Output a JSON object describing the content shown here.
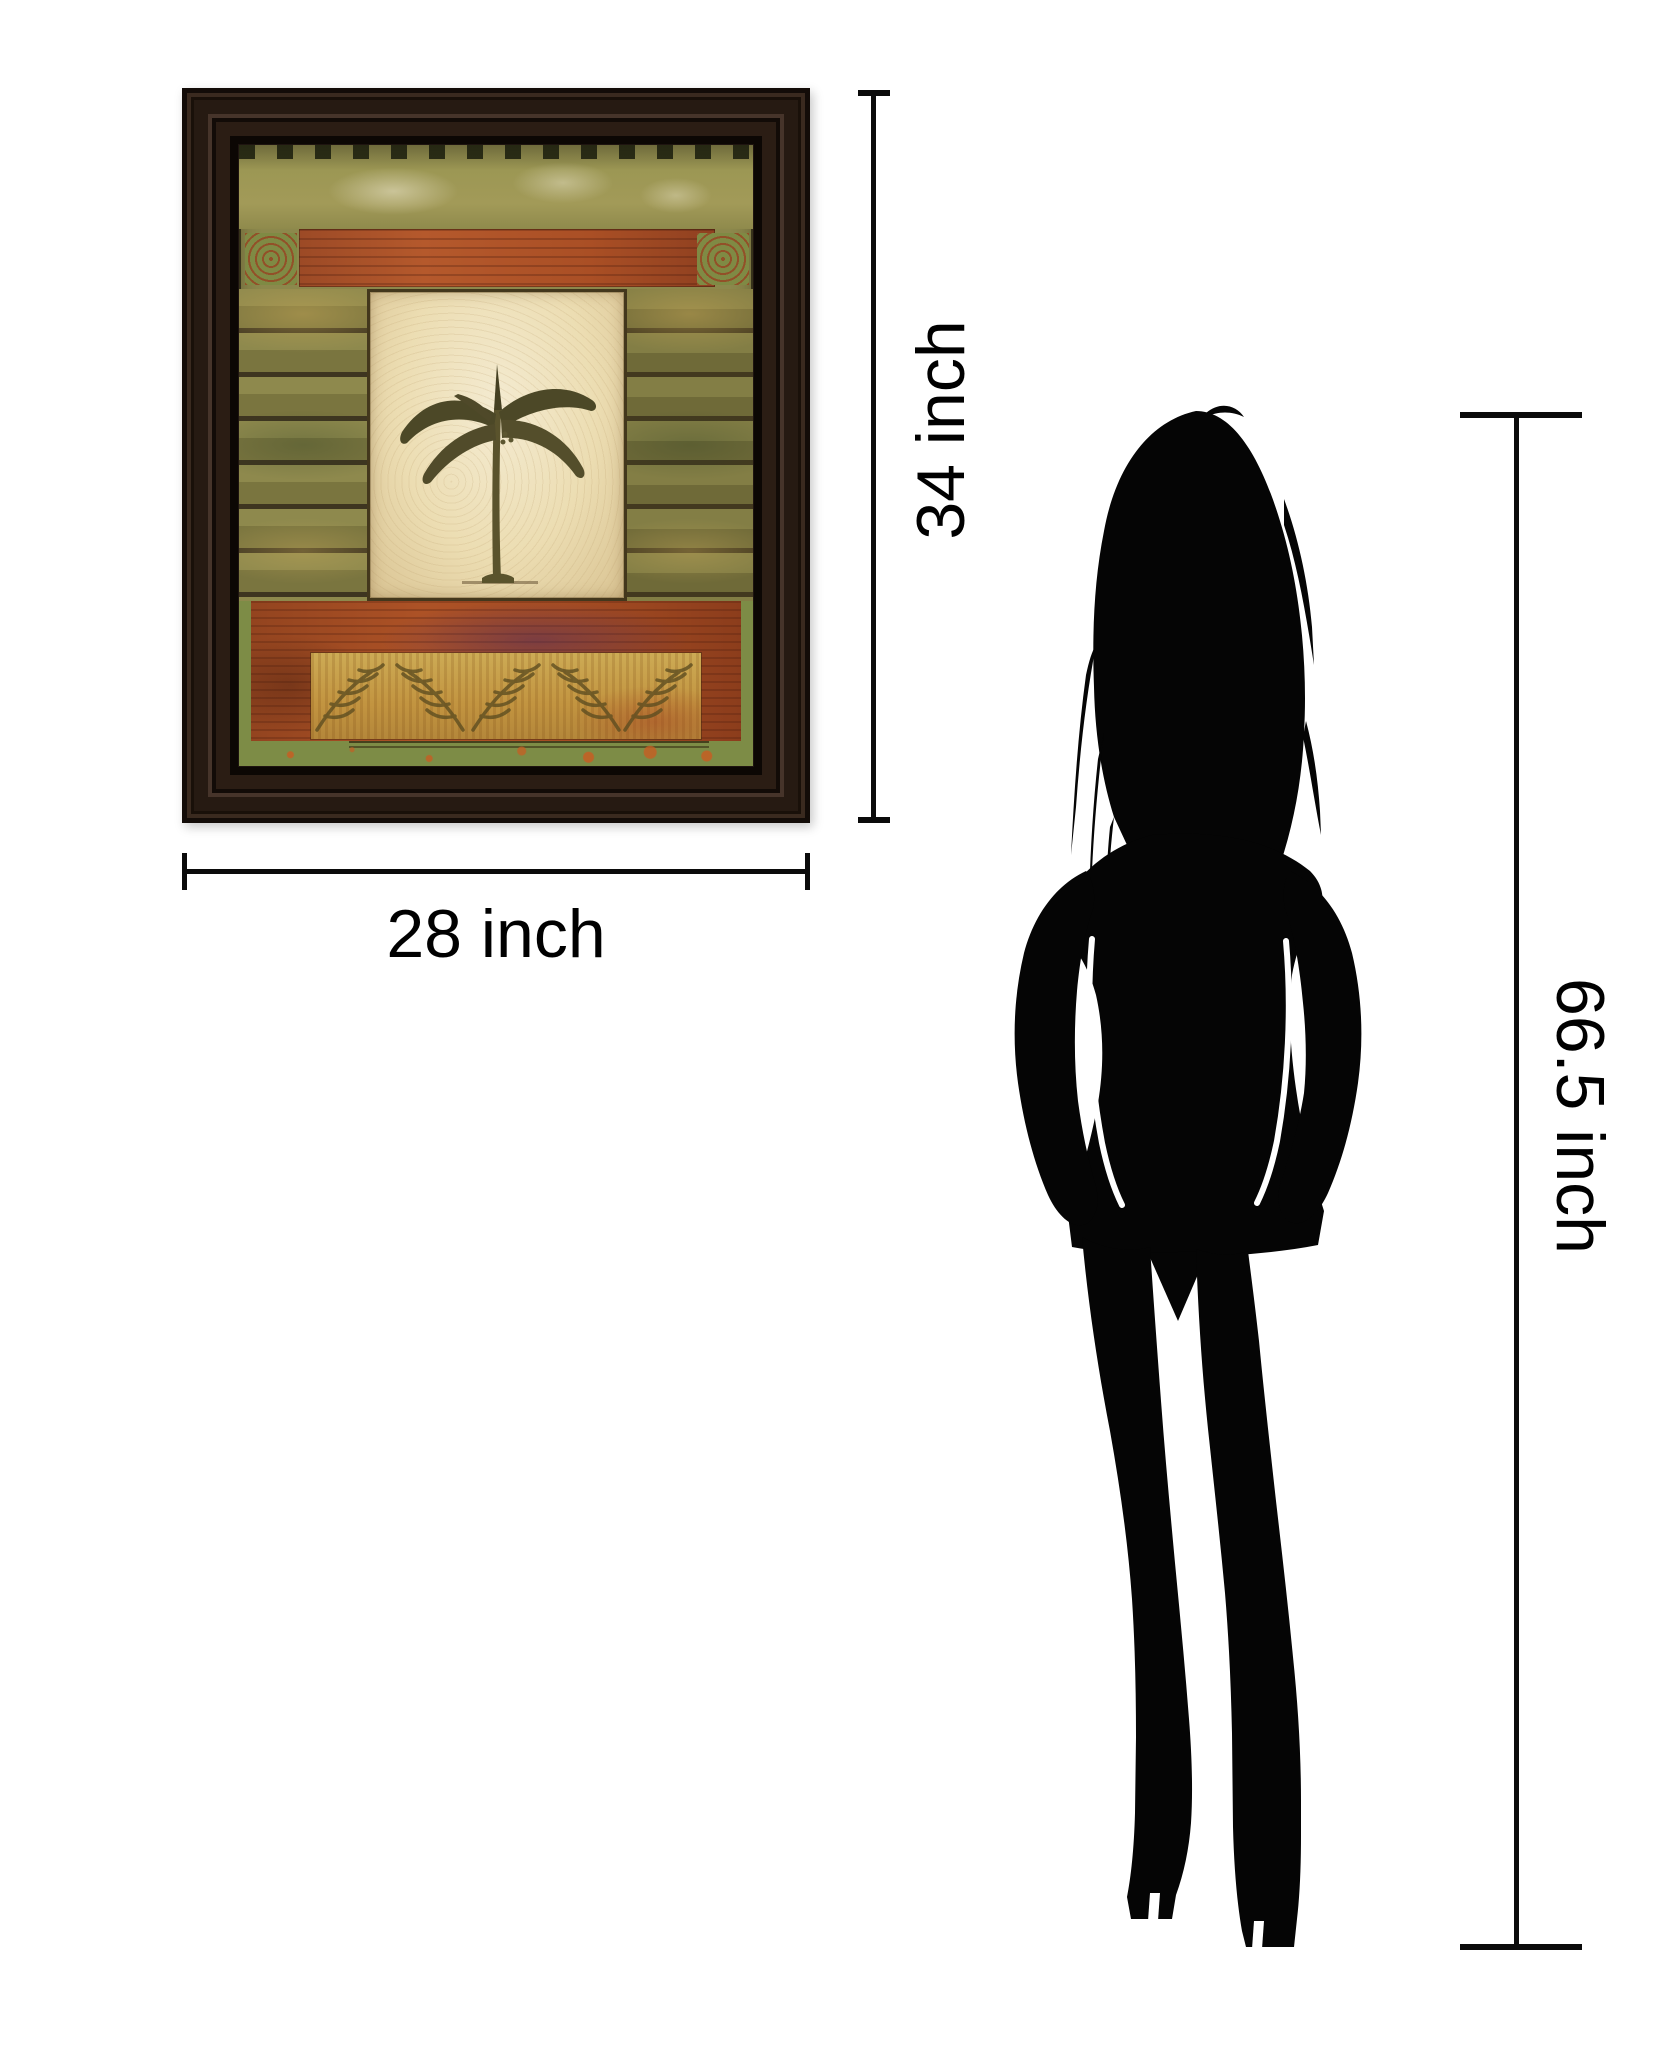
{
  "image_type": "product dimension comparison",
  "artwork": {
    "name": "framed botanical palm patchwork print",
    "frame_color": "#1e1410",
    "palette": {
      "green": "#8c884c",
      "rust_red": "#a84e26",
      "gold": "#c9a54e",
      "cream_panel": "#efe2ba",
      "leaf_olive": "#4c4827"
    }
  },
  "measurements": {
    "art_height": {
      "label": "34 inch"
    },
    "art_width": {
      "label": "28 inch"
    },
    "figure_height": {
      "label": "66.5 inch"
    }
  },
  "reference_figure": {
    "type": "woman silhouette",
    "color": "#050505"
  },
  "style": {
    "line_color": "#0b0b0b",
    "label_color": "#000000",
    "background": "#ffffff"
  }
}
